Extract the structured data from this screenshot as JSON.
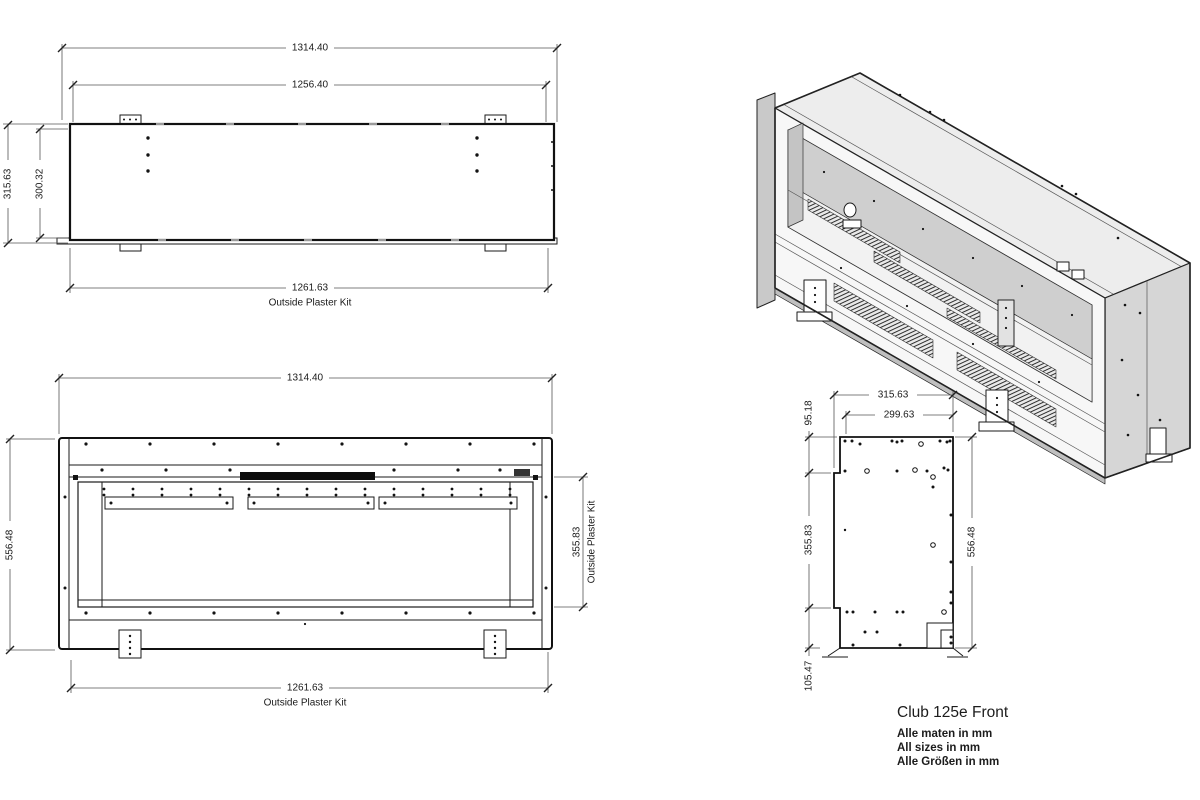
{
  "drawing": {
    "caption": {
      "title": "Club 125e Front",
      "note_nl": "Alle maten in mm",
      "note_en": "All sizes in mm",
      "note_de": "Alle Größen in mm"
    },
    "labels": {
      "outside_plaster_kit": "Outside Plaster Kit"
    },
    "top_view": {
      "overall_width": "1314.40",
      "body_width": "1256.40",
      "overall_depth": "315.63",
      "body_depth": "300.32",
      "plaster_kit_width": "1261.63"
    },
    "front_view": {
      "overall_width": "1314.40",
      "overall_height": "556.48",
      "opening_height": "355.83",
      "plaster_kit_width": "1261.63"
    },
    "side_view": {
      "overall_depth": "315.63",
      "body_depth": "299.63",
      "top_offset": "95.18",
      "opening_height": "355.83",
      "bottom_offset": "105.47",
      "overall_height": "556.48"
    }
  }
}
